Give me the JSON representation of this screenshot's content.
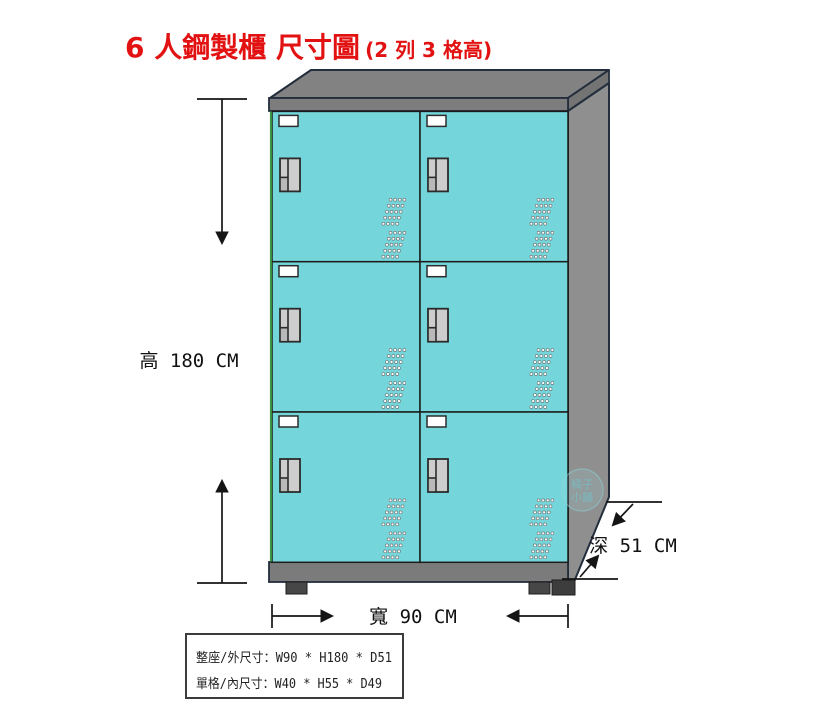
{
  "title": {
    "main": "6 人鋼製櫃 尺寸圖",
    "sub": "(2 列 3 格高)"
  },
  "dimension_labels": {
    "height": "高 180 CM",
    "width": "寬 90 CM",
    "depth": "深 51 CM"
  },
  "spec_box": {
    "outer": "整座/外尺寸：W90 * H180 * D51",
    "inner": "單格/內尺寸：W40 * H55 * D49"
  },
  "watermark": {
    "line1": "橘子",
    "line2": "小舖"
  },
  "locker": {
    "door_count": 6,
    "columns": 2,
    "rows": 3
  },
  "colors": {
    "background": "#ffffff",
    "title_red": "#e31212",
    "door_cyan": "#74d6da",
    "cabinet_top": "#828282",
    "cabinet_band": "#7d7d7d",
    "cabinet_side": "#8f8f8f",
    "cabinet_base": "#7b7b7b",
    "slab_edge": "#747474",
    "outline": "#232e3c",
    "handle_fill": "#cdcdcd",
    "foot": "#474747",
    "dimension_line": "#151515",
    "left_edge_green": "#3f9b41"
  }
}
